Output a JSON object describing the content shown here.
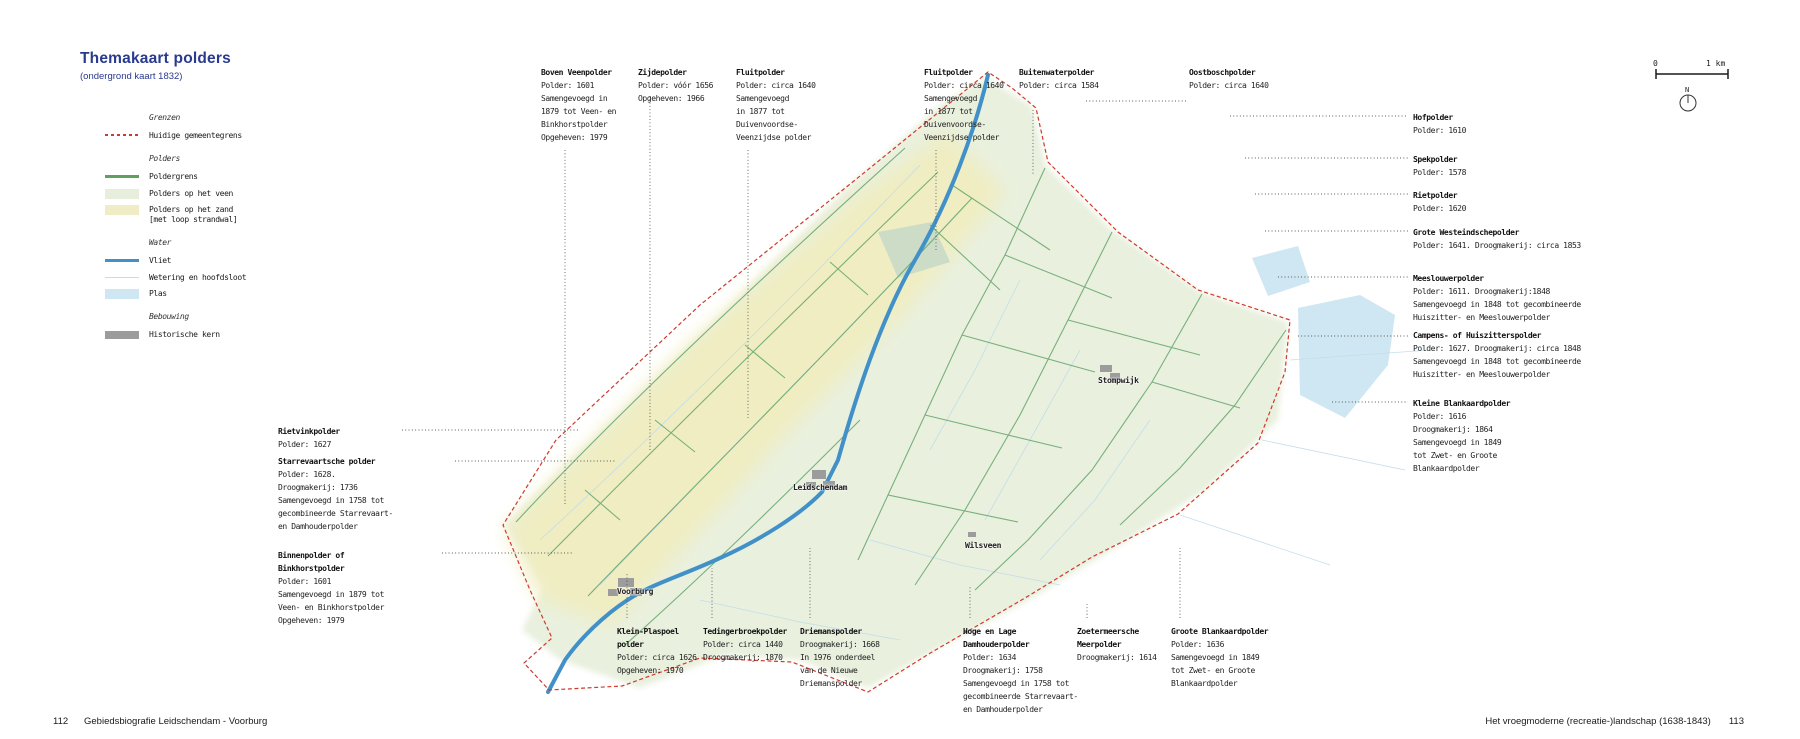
{
  "page": {
    "title": "Themakaart polders",
    "subtitle": "(ondergrond kaart 1832)"
  },
  "legend": {
    "sections": [
      {
        "heading": "Grenzen",
        "items": [
          {
            "label": [
              "Huidige gemeentegrens"
            ]
          }
        ]
      },
      {
        "heading": "Polders",
        "items": [
          {
            "label": [
              "Poldergrens"
            ]
          },
          {
            "label": [
              "Polders op het veen"
            ]
          },
          {
            "label": [
              "Polders op het zand",
              "[met loop strandwal]"
            ]
          }
        ]
      },
      {
        "heading": "Water",
        "items": [
          {
            "label": [
              "Vliet"
            ]
          },
          {
            "label": [
              "Wetering en hoofdsloot"
            ]
          },
          {
            "label": [
              "Plas"
            ]
          }
        ]
      },
      {
        "heading": "Bebouwing",
        "items": [
          {
            "label": [
              "Historische kern"
            ]
          }
        ]
      }
    ]
  },
  "annotations": {
    "top": [
      {
        "title": [
          "Boven Veenpolder"
        ],
        "details": [
          "Polder: 1601",
          "Samengevoegd in",
          "1879 tot Veen- en",
          "Binkhorstpolder",
          "Opgeheven: 1979"
        ]
      },
      {
        "title": [
          "Zijdepolder"
        ],
        "details": [
          "Polder: vóór 1656",
          "Opgeheven: 1966"
        ]
      },
      {
        "title": [
          "Fluitpolder"
        ],
        "details": [
          "Polder: circa 1640",
          "Samengevoegd",
          "in 1877 tot",
          "Duivenvoordse-",
          "Veenzijdse polder"
        ]
      },
      {
        "title": [
          "Fluitpolder"
        ],
        "details": [
          "Polder: circa 1640",
          "Samengevoegd",
          "in 1877 tot",
          "Duivenvoordse-",
          "Veenzijdse polder"
        ]
      },
      {
        "title": [
          "Buitenwaterpolder"
        ],
        "details": [
          "Polder: circa 1584"
        ]
      },
      {
        "title": [
          "Oostboschpolder"
        ],
        "details": [
          "Polder: circa 1640"
        ]
      }
    ],
    "right": [
      {
        "title": [
          "Hofpolder"
        ],
        "details": [
          "Polder: 1610"
        ]
      },
      {
        "title": [
          "Spekpolder"
        ],
        "details": [
          "Polder: 1578"
        ]
      },
      {
        "title": [
          "Rietpolder"
        ],
        "details": [
          "Polder: 1620"
        ]
      },
      {
        "title": [
          "Grote Westeindschepolder"
        ],
        "details": [
          "Polder: 1641. Droogmakerij: circa 1853"
        ]
      },
      {
        "title": [
          "Meeslouwerpolder"
        ],
        "details": [
          "Polder: 1611. Droogmakerij:1848",
          "Samengevoegd in 1848 tot gecombineerde",
          "Huiszitter- en Meeslouwerpolder"
        ]
      },
      {
        "title": [
          "Campens- of Huiszitterspolder"
        ],
        "details": [
          "Polder: 1627. Droogmakerij: circa 1848",
          "Samengevoegd in 1848 tot gecombineerde",
          "Huiszitter- en Meeslouwerpolder"
        ]
      },
      {
        "title": [
          "Kleine Blankaardpolder"
        ],
        "details": [
          "Polder: 1616",
          "Droogmakerij: 1864",
          "Samengevoegd in 1849",
          "tot Zwet- en Groote",
          "Blankaardpolder"
        ]
      }
    ],
    "left": [
      {
        "title": [
          "Rietvinkpolder"
        ],
        "details": [
          "Polder: 1627"
        ]
      },
      {
        "title": [
          "Starrevaartsche polder"
        ],
        "details": [
          "Polder: 1628.",
          "Droogmakerij: 1736",
          "Samengevoegd in 1758 tot",
          "gecombineerde Starrevaart-",
          "en Damhouderpolder"
        ]
      },
      {
        "title": [
          "Binnenpolder of",
          "Binkhorstpolder"
        ],
        "details": [
          "Polder: 1601",
          "Samengevoegd in 1879 tot",
          "Veen- en Binkhorstpolder",
          "Opgeheven: 1979"
        ]
      }
    ],
    "bottom": [
      {
        "title": [
          "Klein-Plaspoel",
          "polder"
        ],
        "details": [
          "Polder: circa 1626",
          "Opgeheven: 1970"
        ]
      },
      {
        "title": [
          "Tedingerbroekpolder"
        ],
        "details": [
          "Polder: circa 1440",
          "Droogmakerij: 1870"
        ]
      },
      {
        "title": [
          "Driemanspolder"
        ],
        "details": [
          "Droogmakerij: 1668",
          "In 1976 onderdeel",
          "van de Nieuwe",
          "Driemanspolder"
        ]
      },
      {
        "title": [
          "Hoge en Lage",
          "Damhouderpolder"
        ],
        "details": [
          "Polder: 1634",
          "Droogmakerij: 1758",
          "Samengevoegd in 1758 tot",
          "gecombineerde Starrevaart-",
          "en Damhouderpolder"
        ]
      },
      {
        "title": [
          "Zoetermeersche",
          "Meerpolder"
        ],
        "details": [
          "Droogmakerij: 1614"
        ]
      },
      {
        "title": [
          "Groote Blankaardpolder"
        ],
        "details": [
          "Polder: 1636",
          "Samengevoegd in 1849",
          "tot Zwet- en Groote",
          "Blankaardpolder"
        ]
      }
    ]
  },
  "map": {
    "places": [
      "Leidschendam",
      "Voorburg",
      "Stompwijk",
      "Wilsveen"
    ]
  },
  "scalebar": {
    "zero": "0",
    "one_km": "1 km",
    "north": "N"
  },
  "footer": {
    "page_number_left": "112",
    "book_title": "Gebiedsbiografie Leidschendam - Voorburg",
    "chapter_title": "Het vroegmoderne (recreatie-)landschap (1638-1843)",
    "page_number_right": "113"
  },
  "colors": {
    "title_blue": "#2a3a8e",
    "municipal_boundary_red": "#cf3a2c",
    "polder_boundary_green": "#5fa05f",
    "veen_fill": "#e7efdc",
    "zand_fill": "#f0edc6",
    "vliet_blue": "#4190c8",
    "wetering_blue": "#c2dcea",
    "plas_fill": "#cfe7f2",
    "historic_core_gray": "#9c9c9c"
  }
}
